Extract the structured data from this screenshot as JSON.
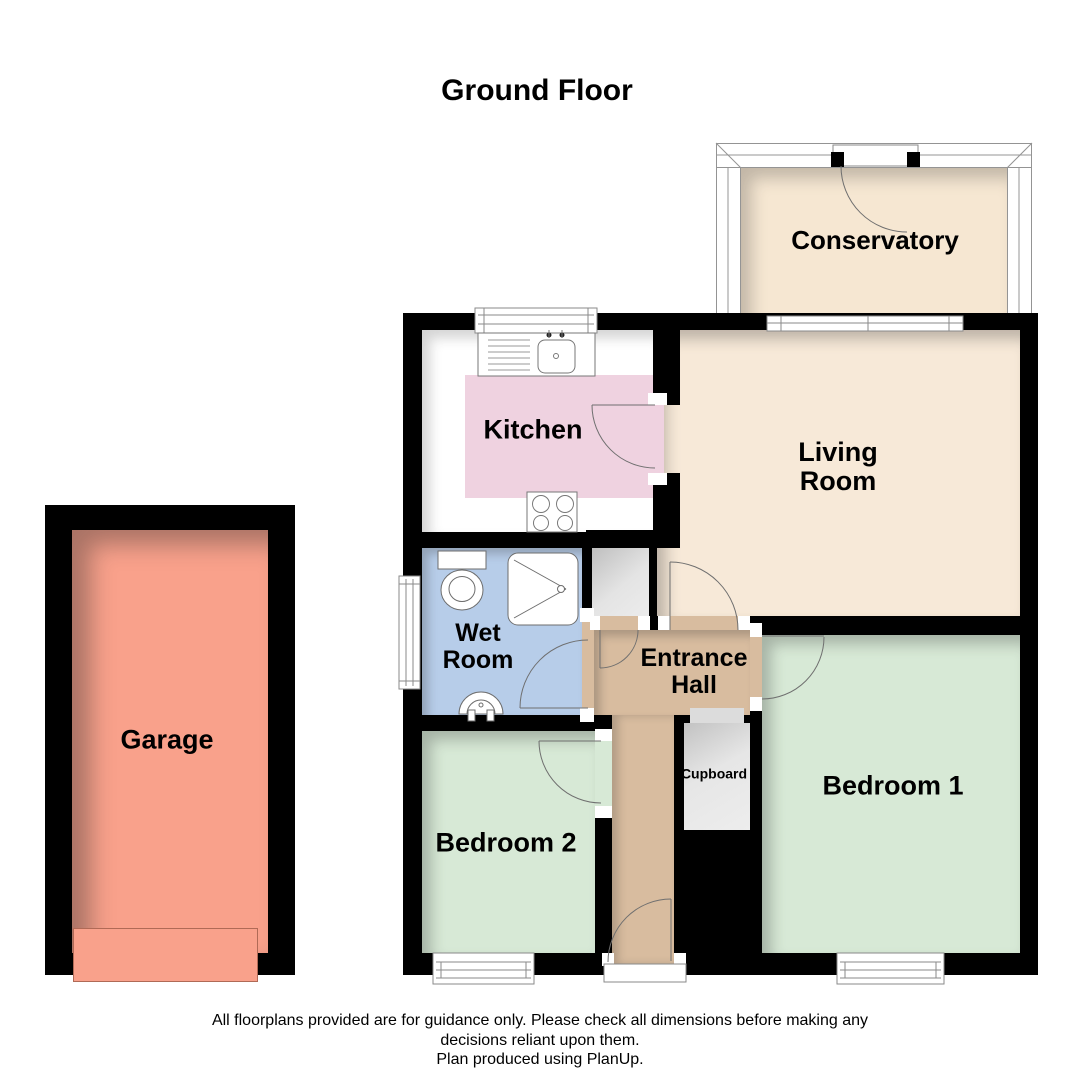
{
  "title": "Ground Floor",
  "rooms": {
    "conservatory": {
      "label": "Conservatory"
    },
    "kitchen": {
      "label": "Kitchen"
    },
    "living_room": {
      "line1": "Living",
      "line2": "Room"
    },
    "wet_room": {
      "line1": "Wet",
      "line2": "Room"
    },
    "entrance_hall": {
      "line1": "Entrance",
      "line2": "Hall"
    },
    "cupboard": {
      "label": "Cupboard"
    },
    "bedroom1": {
      "label": "Bedroom 1"
    },
    "bedroom2": {
      "label": "Bedroom 2"
    },
    "garage": {
      "label": "Garage"
    }
  },
  "footer": {
    "line1": "All floorplans provided are for guidance only. Please check all dimensions before making any",
    "line2": "decisions reliant upon them.",
    "line3": "Plan produced using PlanUp."
  },
  "colors": {
    "wall": "#000000",
    "conservatory": "#f6e7d2",
    "living": "#f7e9d8",
    "kitchen_floor": "#ffffff",
    "kitchen_units": "#efd2e0",
    "wet_room": "#b7cde9",
    "hall": "#d8bc9f",
    "cupboard": "#e0e0e0",
    "bedroom": "#d7e9d6",
    "garage": "#f9a18b"
  }
}
